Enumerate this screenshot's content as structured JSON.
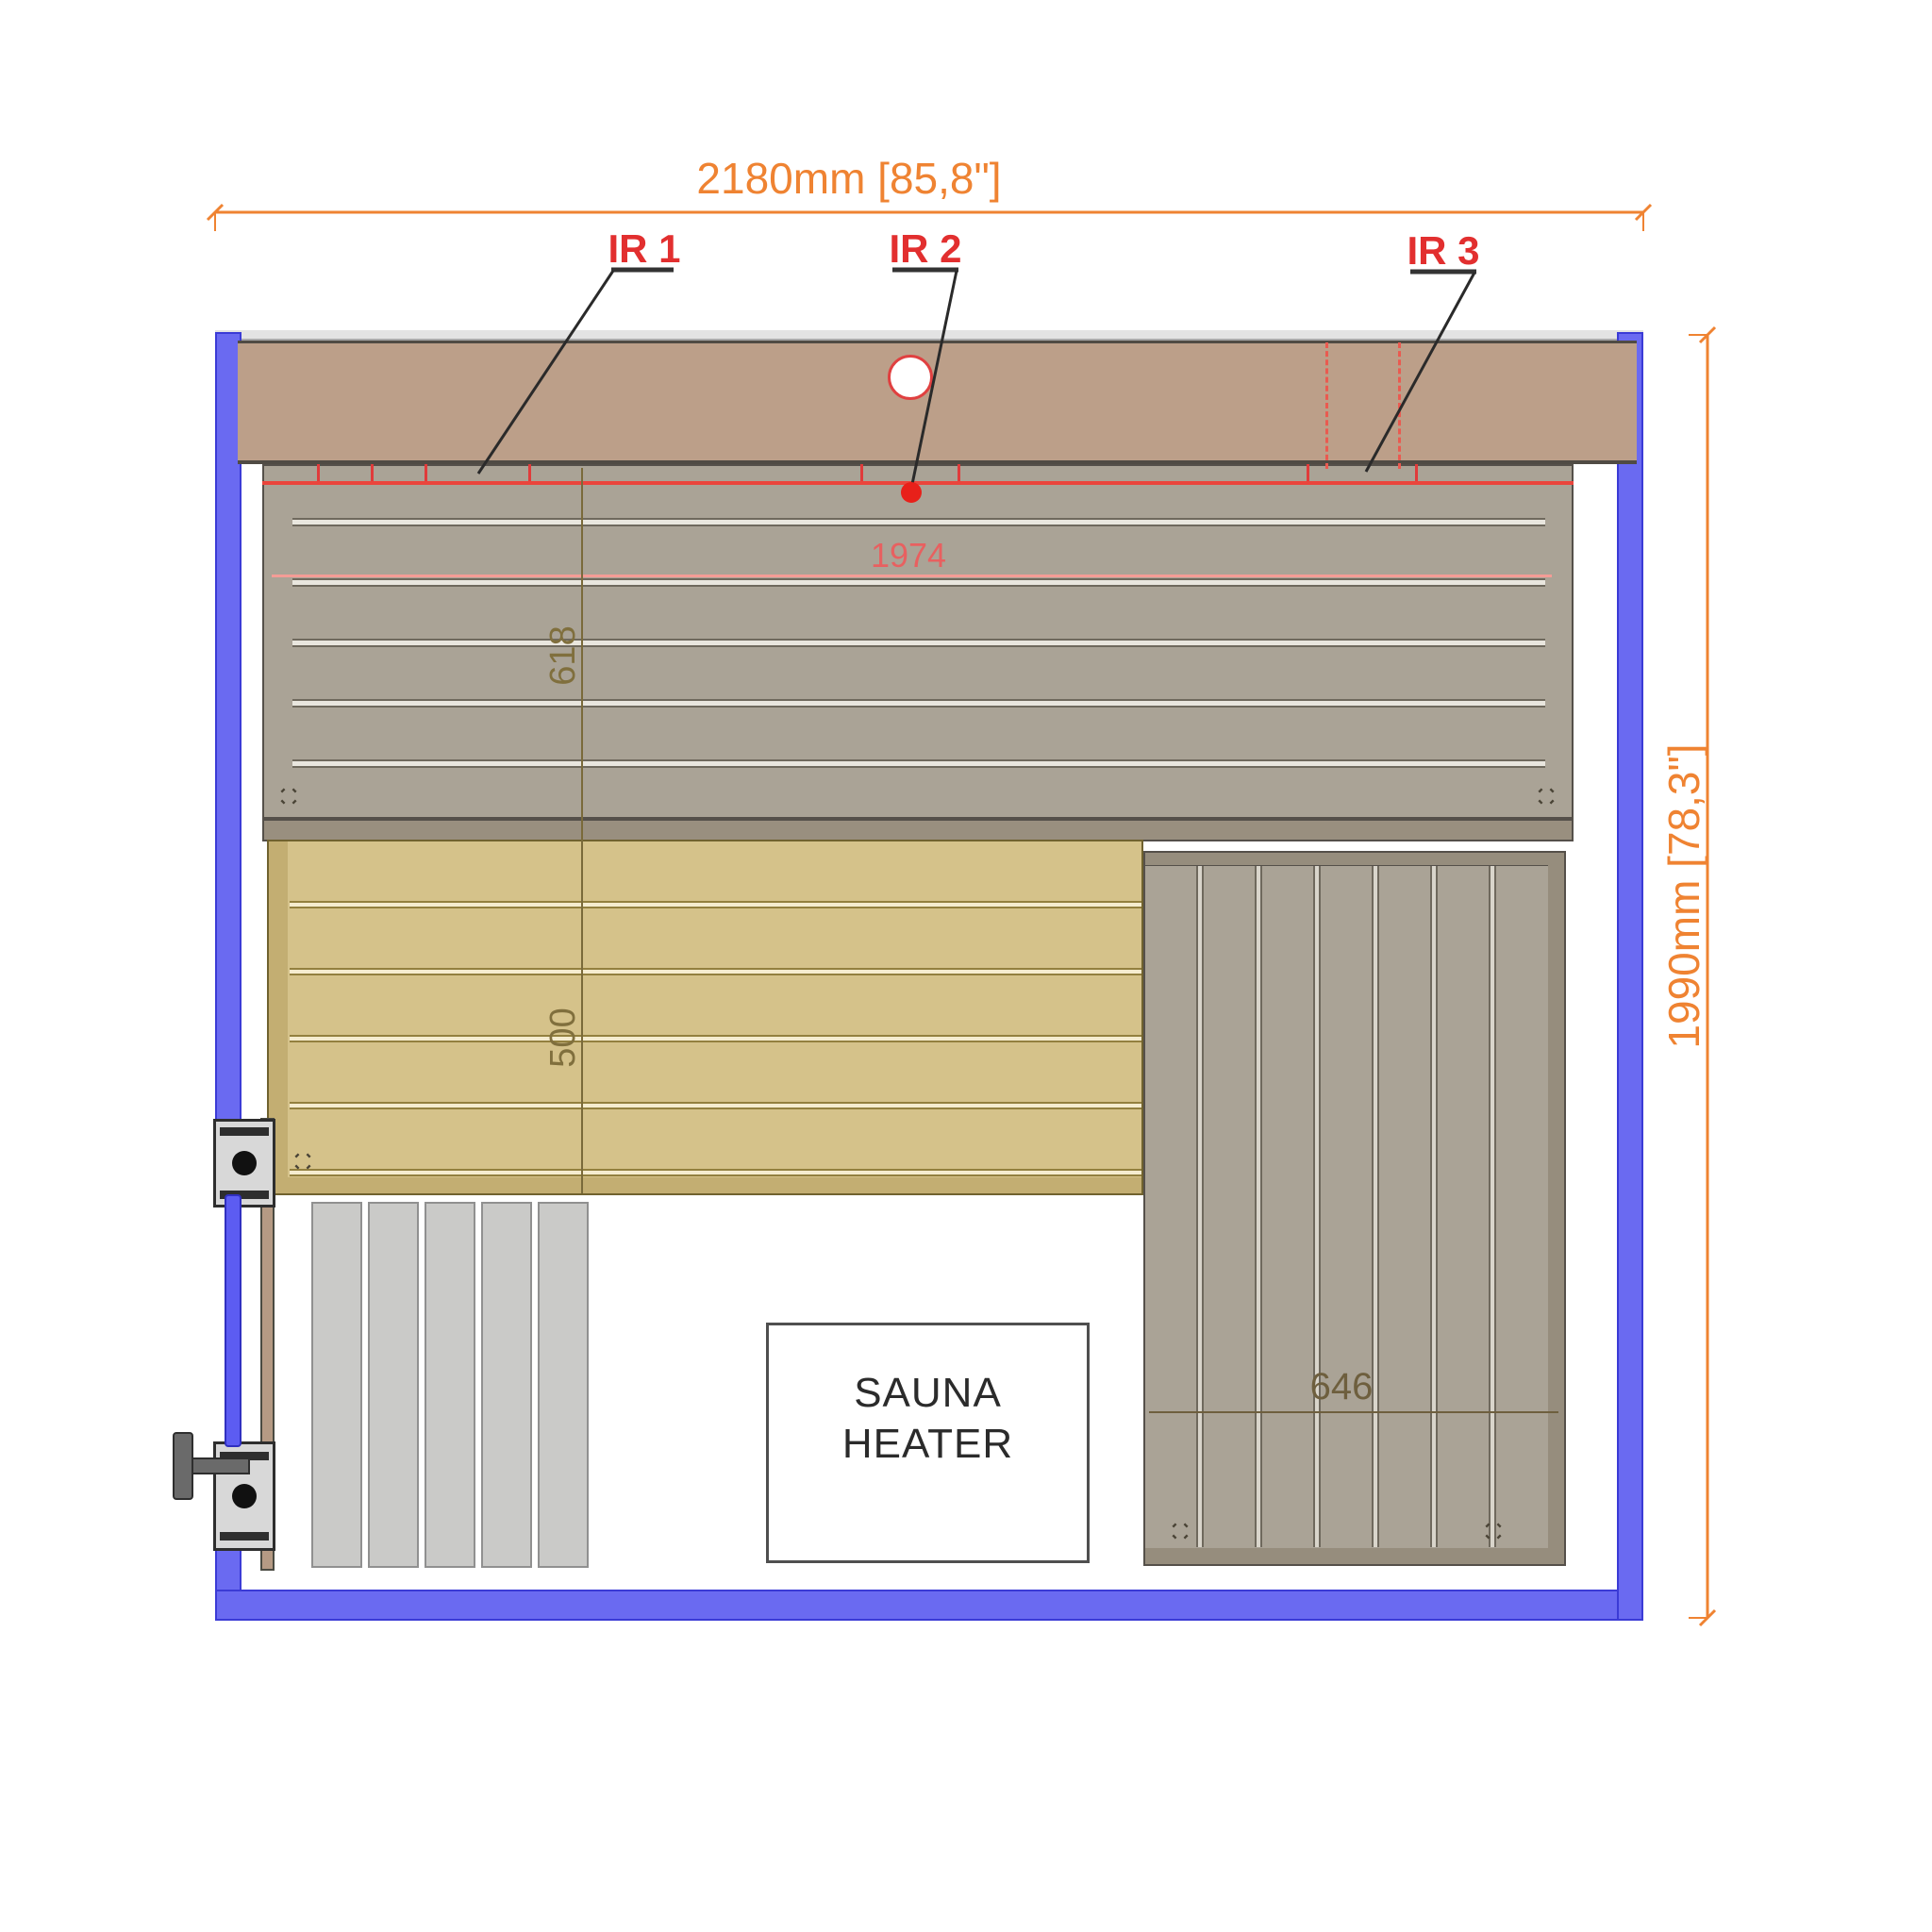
{
  "drawing": {
    "dimensions": {
      "overall_width": "2180mm [85,8\"]",
      "overall_depth": "1990mm [78,3\"]",
      "upper_bench_depth": "618",
      "lower_bench_depth": "500",
      "bench_length": "1974",
      "side_bench_width": "646"
    },
    "ir_panels": [
      {
        "label": "IR 1"
      },
      {
        "label": "IR 2"
      },
      {
        "label": "IR 3"
      }
    ],
    "heater": {
      "line1": "SAUNA",
      "line2": "HEATER"
    },
    "colors": {
      "wall_blue": "#6a6af1",
      "dimension_orange": "#ef8332",
      "ir_red": "#e22f2f",
      "backrest_tan": "#bc9f89",
      "bench_gray": "#aaa396",
      "bench_yellow": "#d5c28a",
      "floor_strip_gray": "#cacac8"
    }
  }
}
